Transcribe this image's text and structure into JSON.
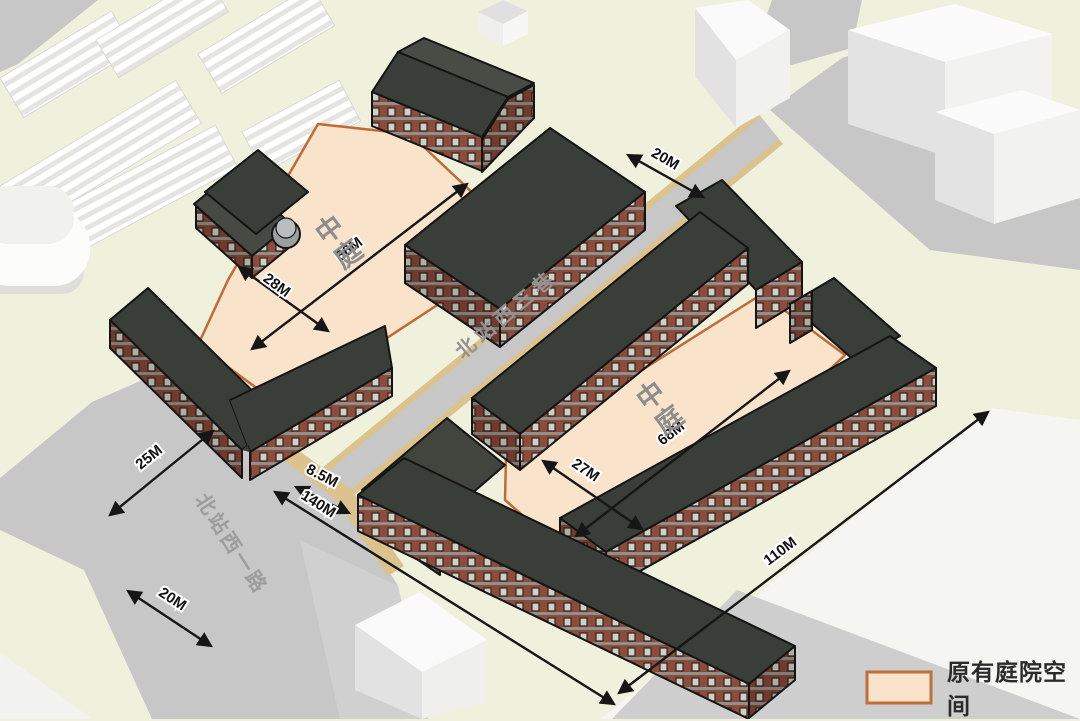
{
  "diagram": {
    "courtyards": {
      "left": {
        "label": "中庭",
        "length": "66M",
        "width": "28M"
      },
      "right": {
        "label": "中庭",
        "length": "68M",
        "width": "27M"
      }
    },
    "streets": {
      "north_lane": "北站西三巷",
      "west_road": "北站西一路"
    },
    "dims": [
      {
        "label": "20M"
      },
      {
        "label": "66M"
      },
      {
        "label": "28M"
      },
      {
        "label": "25M"
      },
      {
        "label": "8.5M"
      },
      {
        "label": "140M"
      },
      {
        "label": "20M"
      },
      {
        "label": "27M"
      },
      {
        "label": "68M"
      },
      {
        "label": "110M"
      }
    ],
    "legend": {
      "label": "原有庭院空间",
      "swatch_color": "#fae3cb",
      "swatch_border": "#bf6f38"
    },
    "colors": {
      "background": "#f0f1dc",
      "courtyard_fill": "#fae3cb",
      "courtyard_border": "#c06a35",
      "roof": "#3a3e38",
      "brick_light": "#8c4c3b",
      "brick_dark": "#703a2e",
      "road_gray": "#c7c7c7",
      "curb_tan": "#dcc28d",
      "dimension_line": "#161616"
    }
  }
}
